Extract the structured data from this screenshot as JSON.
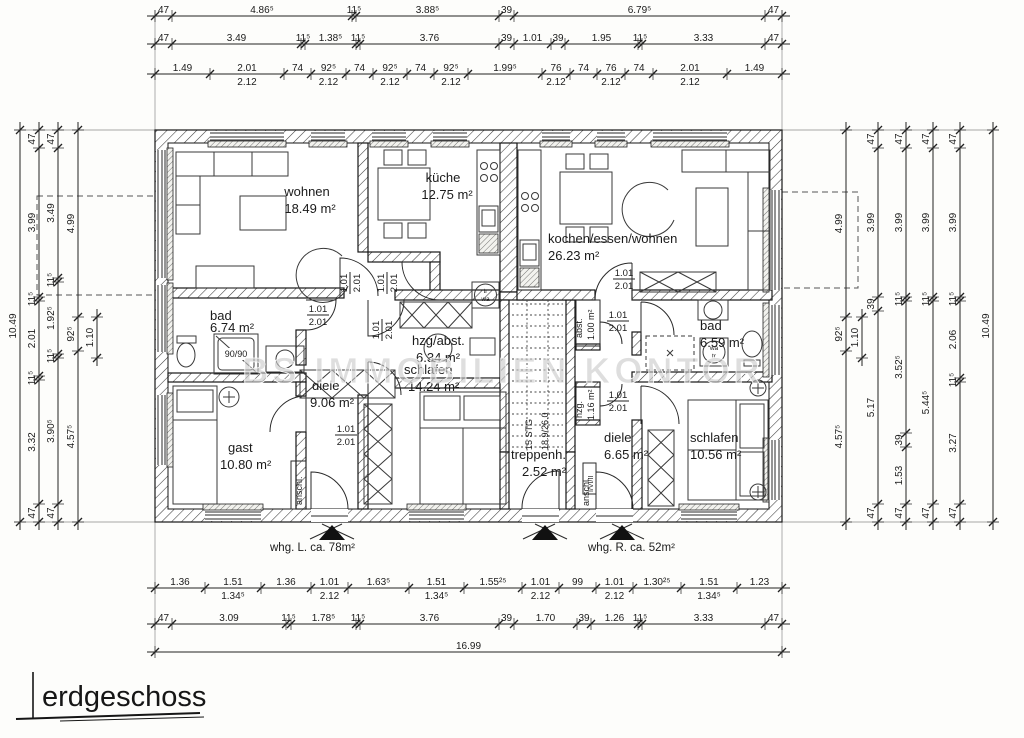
{
  "title": {
    "name": "erdgeschoss"
  },
  "watermark": "BS IMMOBILIEN KONTOR",
  "apartment_labels": {
    "left": "whg. L. ca. 78m²",
    "right": "whg. R. ca. 52m²"
  },
  "door_label": {
    "w": "1.01",
    "h": "2.01"
  },
  "rooms": {
    "wohnen": {
      "name": "wohnen",
      "area": "18.49 m²"
    },
    "kueche": {
      "name": "küche",
      "area": "12.75 m²"
    },
    "kochen": {
      "name": "kochen/essen/wohnen",
      "area": "26.23 m²"
    },
    "bad_l": {
      "name": "bad",
      "area": "6.74 m²"
    },
    "hzg_abst": {
      "name": "hzg/abst.",
      "area": "6.34 m²"
    },
    "diele_l": {
      "name": "diele",
      "area": "9.06 m²"
    },
    "schlafen_l": {
      "name": "schlafen",
      "area": "14.24 m²"
    },
    "gast": {
      "name": "gast",
      "area": "10.80 m²"
    },
    "treppenh": {
      "name": "treppenh.",
      "area": "2.52 m²"
    },
    "bad_r": {
      "name": "bad",
      "area": "6.59 m²"
    },
    "diele_r": {
      "name": "diele",
      "area": "6.65 m²"
    },
    "schlafen_r": {
      "name": "schlafen",
      "area": "10.56 m²"
    },
    "abst_r": {
      "name": "abst.",
      "area": "1.00 m²"
    },
    "hzg_r": {
      "name": "hzg.",
      "area": "1.16 m²"
    },
    "anschl_l": {
      "name": "anschl."
    },
    "anschl_r": {
      "name": "anschl.",
      "sub": "I/VI/II"
    },
    "stair": {
      "steps": "15 STG",
      "ratio": "18.9/26.0"
    }
  },
  "fixtures": {
    "shower": "90/90",
    "tr": "tr",
    "wa": "wa"
  },
  "dims": {
    "top1": {
      "labels": [
        "47",
        "4.86⁵",
        "11⁵",
        "3.88⁵",
        "39",
        "6.79⁵",
        "47"
      ]
    },
    "top2": {
      "labels": [
        "47",
        "3.49",
        "11⁵",
        "1.38⁵",
        "11⁵",
        "3.76",
        "39",
        "1.01",
        "39",
        "1.95",
        "11⁵",
        "3.33",
        "47"
      ]
    },
    "top3": {
      "labels": [
        "1.49",
        "2.01|2.12",
        "74",
        "92⁵|2.12",
        "74",
        "92⁵|2.12",
        "74",
        "92⁵|2.12",
        "1.99⁵",
        "76|2.12",
        "74",
        "76|2.12",
        "74",
        "2.01|2.12",
        "1.49"
      ]
    },
    "bot1": {
      "labels": [
        "1.36",
        "1.51|1.34⁵",
        "1.36",
        "1.01|2.12",
        "1.63⁵",
        "1.51|1.34⁵",
        "1.55²⁵",
        "1.01|2.12",
        "99",
        "1.01|2.12",
        "1.30²⁵",
        "1.51|1.34⁵",
        "1.23"
      ]
    },
    "bot2": {
      "labels": [
        "47",
        "3.09",
        "11⁵",
        "1.78⁵",
        "11⁵",
        "3.76",
        "39",
        "1.70",
        "39",
        "1.26",
        "11⁵",
        "3.33",
        "47"
      ]
    },
    "bot3": {
      "labels": [
        "16.99"
      ]
    },
    "l1": {
      "labels": [
        "10.49"
      ]
    },
    "l2": {
      "labels": [
        "47",
        "3.99",
        "11⁵",
        "2.01",
        "11⁵",
        "3.32",
        "47"
      ]
    },
    "l3": {
      "labels": [
        "47",
        "3.49",
        "11⁵",
        "1.92⁵",
        "11⁵",
        "3.90⁵",
        "47"
      ]
    },
    "l4": {
      "labels": [
        "4.99",
        "92⁵",
        "4.57⁵"
      ]
    },
    "l5": {
      "labels": [
        "1.10"
      ]
    },
    "r1": {
      "labels": [
        "4.99",
        "92⁵",
        "4.57⁵"
      ]
    },
    "r1b": {
      "labels": [
        "1.10"
      ]
    },
    "r2": {
      "labels": [
        "47",
        "3.99",
        "39",
        "5.17",
        "47"
      ]
    },
    "r3": {
      "labels": [
        "47",
        "3.99",
        "11⁵",
        "3.52⁵",
        "39",
        "1.53",
        "47"
      ]
    },
    "r4": {
      "labels": [
        "47",
        "3.99",
        "11⁵",
        "5.44⁵",
        "47"
      ]
    },
    "r5": {
      "labels": [
        "47",
        "3.99",
        "11⁵",
        "2.06",
        "11⁵",
        "3.27",
        "47"
      ]
    },
    "r6": {
      "labels": [
        "10.49"
      ]
    }
  }
}
